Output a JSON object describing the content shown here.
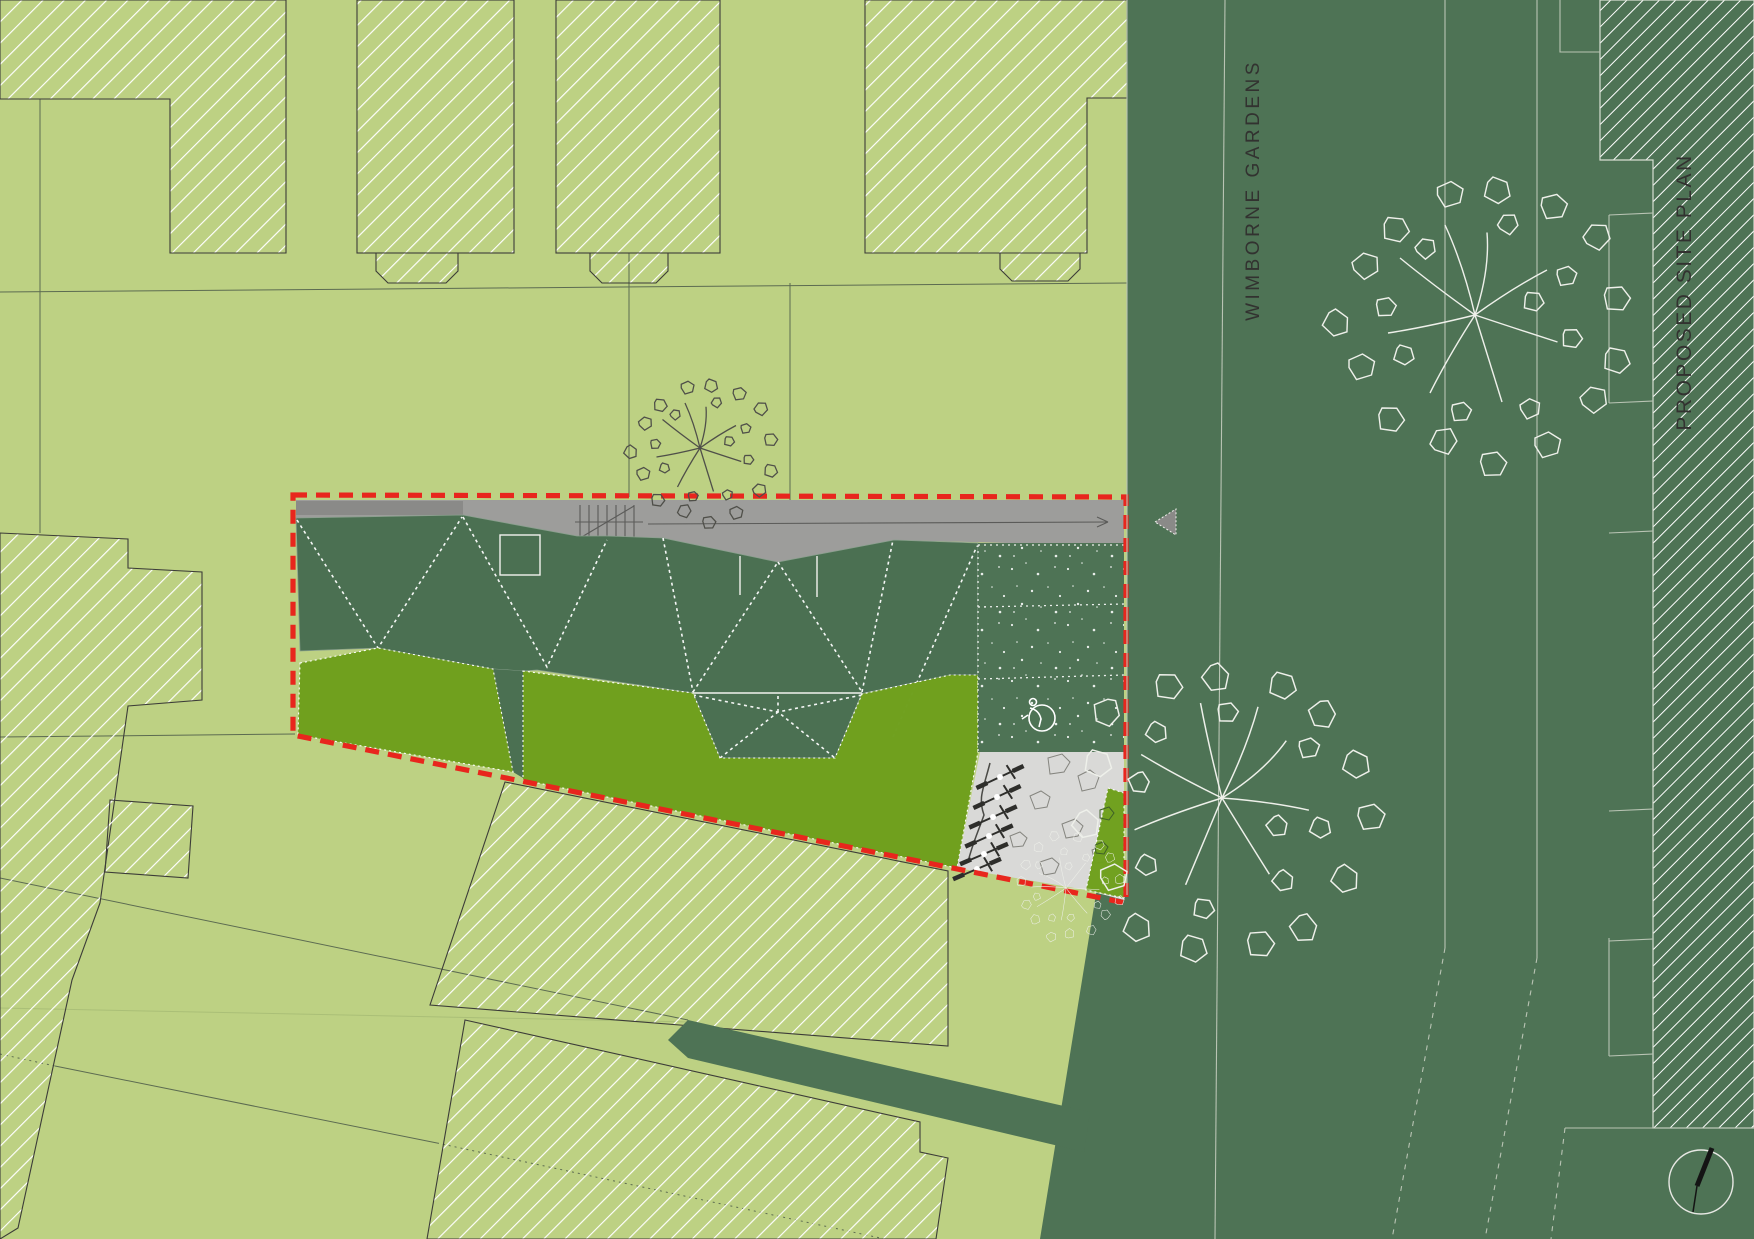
{
  "labels": {
    "street": "WIMBORNE GARDENS",
    "drawing_title": "PROPOSED SITE PLAN"
  },
  "colors": {
    "plot-green": "#bdd183",
    "pale-green": "#c9dc98",
    "road-green": "#4e7355",
    "roof-green": "#4b7052",
    "garden-green": "#6fa01d",
    "deck-gray": "#9d9d9b",
    "paving-gray": "#d9d9d7",
    "boundary-red": "#e8261d",
    "hatch-white": "#ffffff",
    "line-dark": "#3c3c38",
    "tree-dark": "#4f4f49",
    "tree-light": "#eef0ea",
    "text-dark": "#323230"
  },
  "site": {
    "boundary_style": "red dashed site outline",
    "cycle_stands_count": 6,
    "accessible_parking_spaces": 1,
    "icons": [
      "tree-icon",
      "stairs-icon",
      "disabled-parking-icon",
      "cycle-stand-icon",
      "north-arrow-icon",
      "entrance-arrow-icon"
    ]
  }
}
